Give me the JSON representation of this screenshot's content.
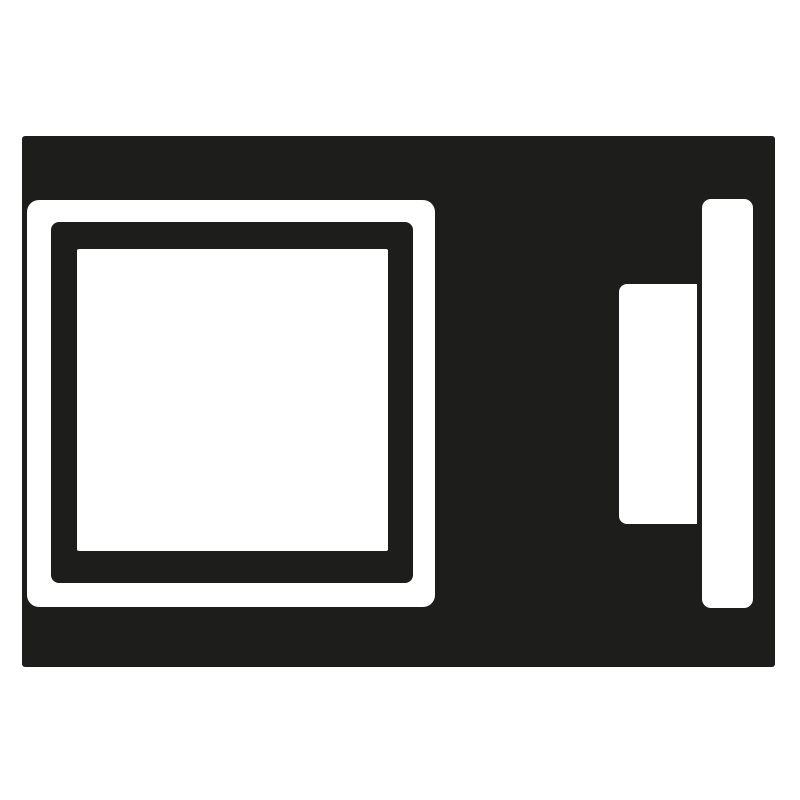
{
  "icon": {
    "name": "appliance-icon",
    "colors": {
      "foreground": "#1d1d1b",
      "background": "#ffffff"
    },
    "parts": [
      {
        "name": "appliance-body"
      },
      {
        "name": "door-frame"
      },
      {
        "name": "door-frame-inner"
      },
      {
        "name": "door-window"
      },
      {
        "name": "control-panel"
      },
      {
        "name": "door-handle"
      }
    ]
  }
}
